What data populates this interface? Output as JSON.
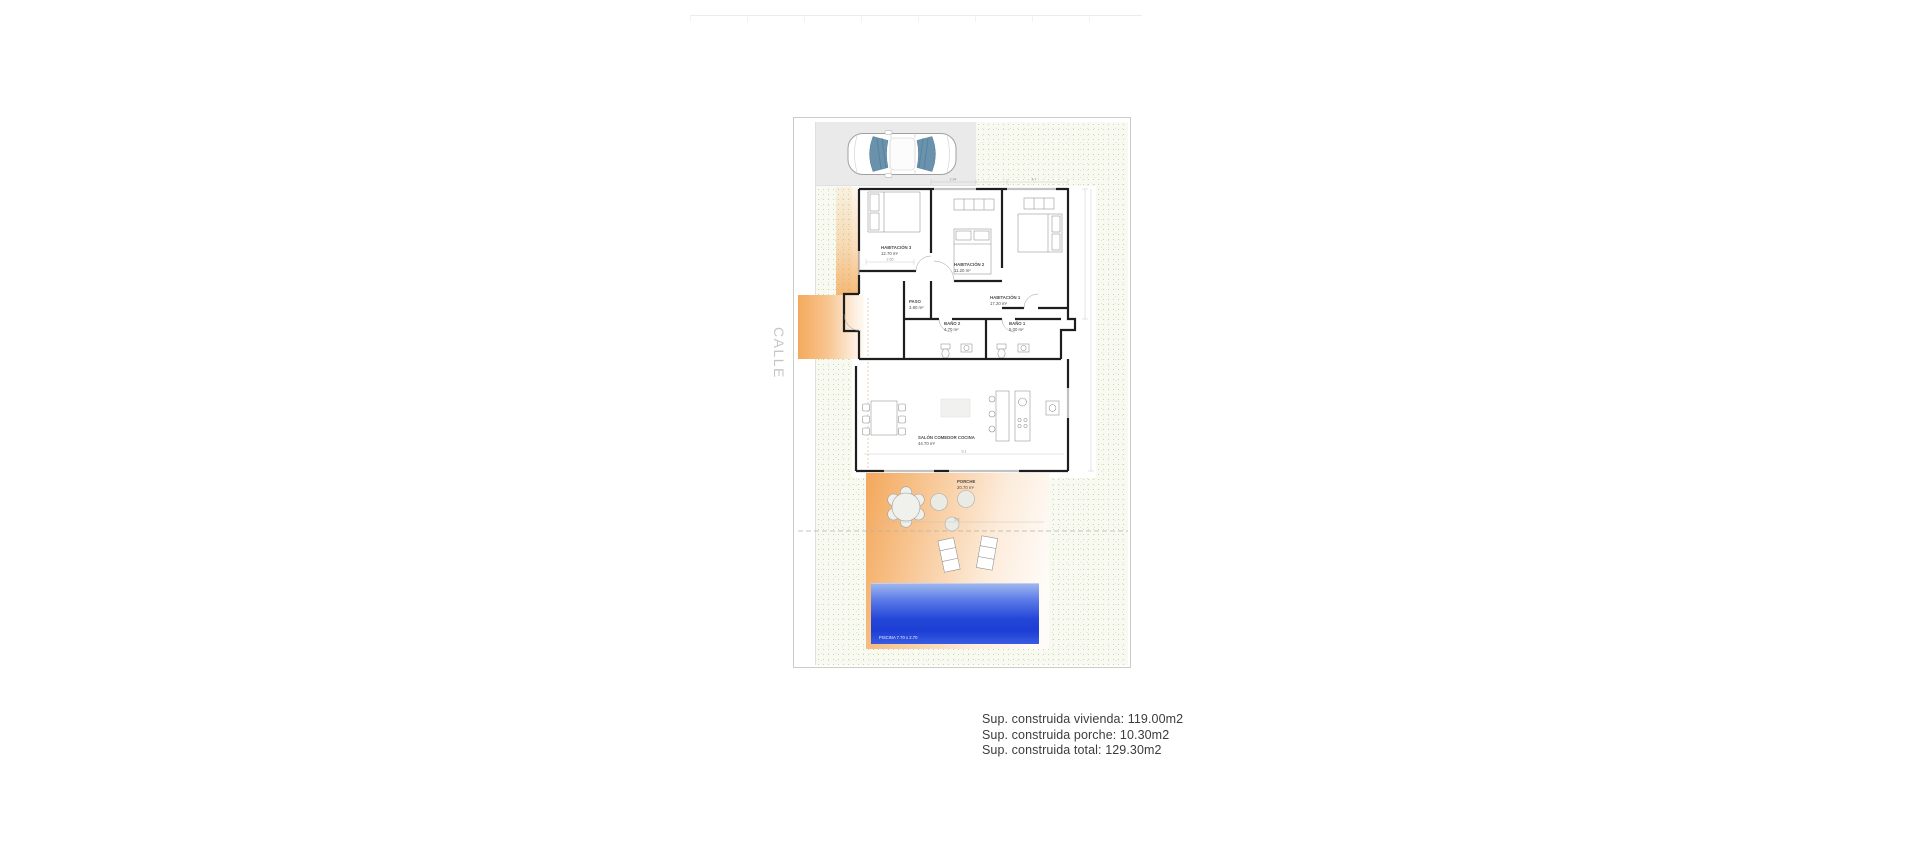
{
  "street_label": "CALLE",
  "rooms": {
    "hab3": {
      "name": "HABITACIÓN 3",
      "area": "12.70 m²"
    },
    "hab2": {
      "name": "HABITACIÓN 2",
      "area": "11.20 m²"
    },
    "hab1": {
      "name": "HABITACIÓN 1",
      "area": "17.20 m²"
    },
    "paso": {
      "name": "PASO",
      "area": "3.80 m²"
    },
    "bano2": {
      "name": "BAÑO 2",
      "area": "4.70 m²"
    },
    "bano1": {
      "name": "BAÑO 1",
      "area": "5.00 m²"
    },
    "salon": {
      "name": "SALÓN COMEDOR COCINA",
      "area": "44.70 m²"
    },
    "porche": {
      "name": "PORCHE",
      "area": "20.70 m²"
    }
  },
  "pool": {
    "label": "PISCINA 7.70 x 2.70"
  },
  "dimensions": {
    "d1": "2.94",
    "d2": "4.7",
    "d3": "2.65",
    "d4": "9.1",
    "d5": "5.2"
  },
  "summary": {
    "line1": "Sup. construida vivienda: 119.00m2",
    "line2": "Sup. construida porche: 10.30m2",
    "line3": "Sup. construida total: 129.30m2"
  },
  "colors": {
    "accent_orange": "#f29e48",
    "pool_blue": "#2447d8",
    "garden_dot": "#c9d8ab",
    "parking_gray": "#eaeaea",
    "wall_black": "#1e1e1e"
  }
}
